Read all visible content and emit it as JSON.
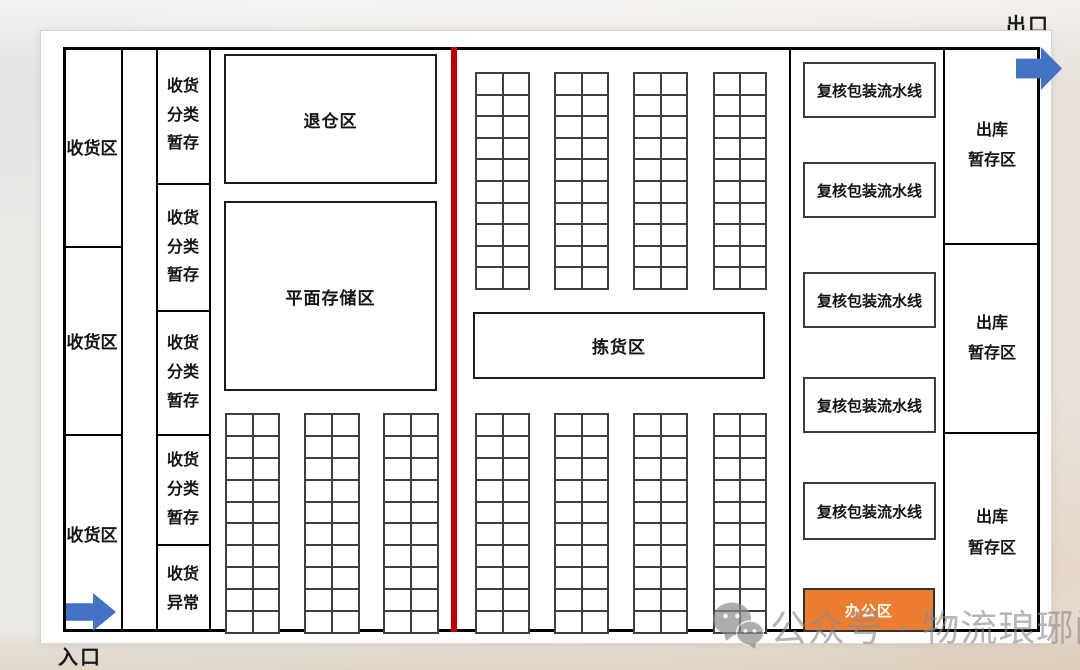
{
  "labels": {
    "exit": "出口",
    "entrance": "入口"
  },
  "receiving": {
    "sections": [
      {
        "label": "收货区"
      },
      {
        "label": "收货区"
      },
      {
        "label": "收货区"
      }
    ]
  },
  "sorting": {
    "sections": [
      {
        "label": "收货\n分类\n暂存"
      },
      {
        "label": "收货\n分类\n暂存"
      },
      {
        "label": "收货\n分类\n暂存"
      },
      {
        "label": "收货\n分类\n暂存"
      },
      {
        "label": "收货\n异常"
      }
    ]
  },
  "storage": {
    "return_zone": "退仓区",
    "flat_storage": "平面存储区",
    "picking": "拣货区"
  },
  "packing": {
    "lines": [
      "复核包装流水线",
      "复核包装流水线",
      "复核包装流水线",
      "复核包装流水线",
      "复核包装流水线"
    ],
    "office": "办公区"
  },
  "outbound": {
    "sections": [
      {
        "label": "出库\n暂存区"
      },
      {
        "label": "出库\n暂存区"
      },
      {
        "label": "出库\n暂存区"
      }
    ]
  },
  "racks": {
    "left_bottom": {
      "count": 3,
      "rows": 10,
      "cols": 2
    },
    "mid_top": {
      "count": 4,
      "rows": 10,
      "cols": 2
    },
    "mid_bottom": {
      "count": 4,
      "rows": 10,
      "cols": 2
    }
  },
  "watermark": {
    "text": "公众号 · 物流琅琊阁",
    "icon": "wechat-icon"
  },
  "colors": {
    "arrow_blue": "#4472C4",
    "office_orange": "#ED7D31",
    "divider_red": "#C00000",
    "wall_black": "#000000",
    "rack_gray": "#3F3F3F",
    "watermark_gray": "#8B8B8B"
  }
}
